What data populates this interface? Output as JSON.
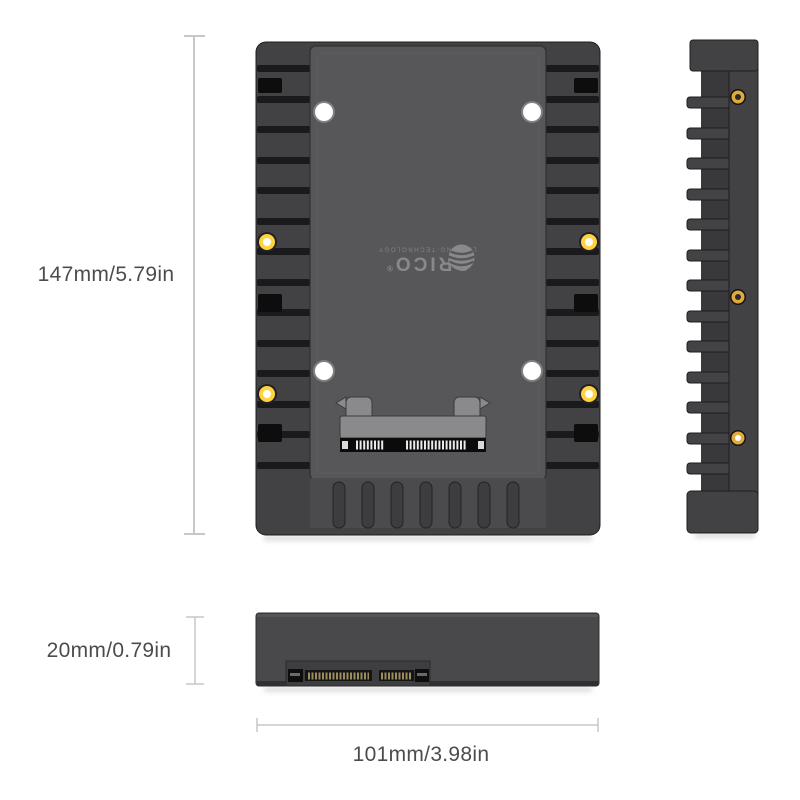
{
  "brand": {
    "wordmark": "ORICO",
    "registered_mark": "®",
    "tagline": "LEADING·TECHNOLOGY"
  },
  "dimension_labels": {
    "height": "147mm/5.79in",
    "thickness": "20mm/0.79in",
    "width": "101mm/3.98in"
  },
  "colors": {
    "background": "#ffffff",
    "frame": "#424244",
    "rib_recess": "#1a1a1c",
    "slot_black": "#0d0d0d",
    "tray": "#57575a",
    "flap": "#4b4b4e",
    "comb_slot": "#3d3d40",
    "hole_white": "#ffffff",
    "screw_gold": "#ffd23f",
    "side_screw_gold": "#e2a93c",
    "bracket_gray": "#8a8a8d",
    "connector_black": "#0b0b0b",
    "pin_white": "#eaeaea",
    "pin_gold": "#9b8d5c",
    "bottom_body": "#49494b",
    "dim_line": "#c7c7c7",
    "dim_text": "#4c4c4c",
    "logo_gray": "#929295"
  }
}
